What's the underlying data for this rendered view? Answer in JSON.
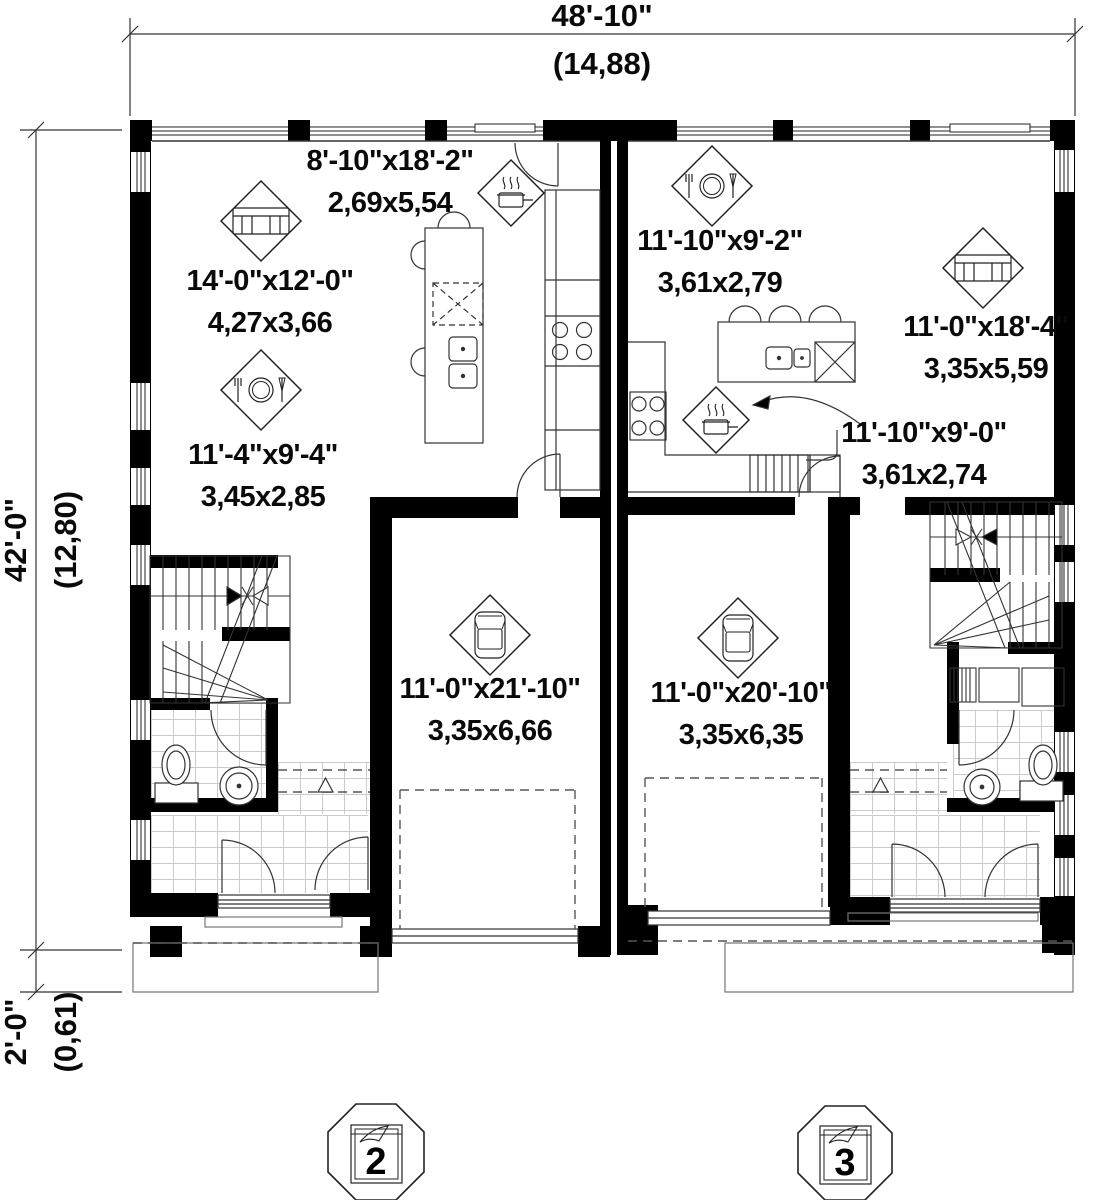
{
  "plan": {
    "dimensions": {
      "width_top": {
        "imperial": "48'-10\"",
        "metric": "(14,88)"
      },
      "height_left": {
        "imperial": "42'-0\"",
        "metric": "(12,80)"
      },
      "porch_left": {
        "imperial": "2'-0\"",
        "metric": "(0,61)"
      }
    },
    "rooms": [
      {
        "id": "kitchen-left",
        "icon": "stove-icon",
        "imperial": "8'-10\"x18'-2\"",
        "metric": "2,69x5,54"
      },
      {
        "id": "living-left",
        "icon": "sofa-icon",
        "imperial": "14'-0\"x12'-0\"",
        "metric": "4,27x3,66"
      },
      {
        "id": "dining-left",
        "icon": "dining-icon",
        "imperial": "11'-4\"x9'-4\"",
        "metric": "3,45x2,85"
      },
      {
        "id": "dining-right",
        "icon": "dining-icon",
        "imperial": "11'-10\"x9'-2\"",
        "metric": "3,61x2,79"
      },
      {
        "id": "living-right",
        "icon": "sofa-icon",
        "imperial": "11'-0\"x18'-4\"",
        "metric": "3,35x5,59"
      },
      {
        "id": "kitchen-right",
        "icon": "stove-icon",
        "imperial": "11'-10\"x9'-0\"",
        "metric": "3,61x2,74"
      },
      {
        "id": "garage-left",
        "icon": "car-icon",
        "imperial": "11'-0\"x21'-10\"",
        "metric": "3,35x6,66"
      },
      {
        "id": "garage-right",
        "icon": "car-icon",
        "imperial": "11'-0\"x20'-10\"",
        "metric": "3,35x6,35"
      }
    ],
    "unit_markers": [
      {
        "number": "2"
      },
      {
        "number": "3"
      }
    ]
  }
}
